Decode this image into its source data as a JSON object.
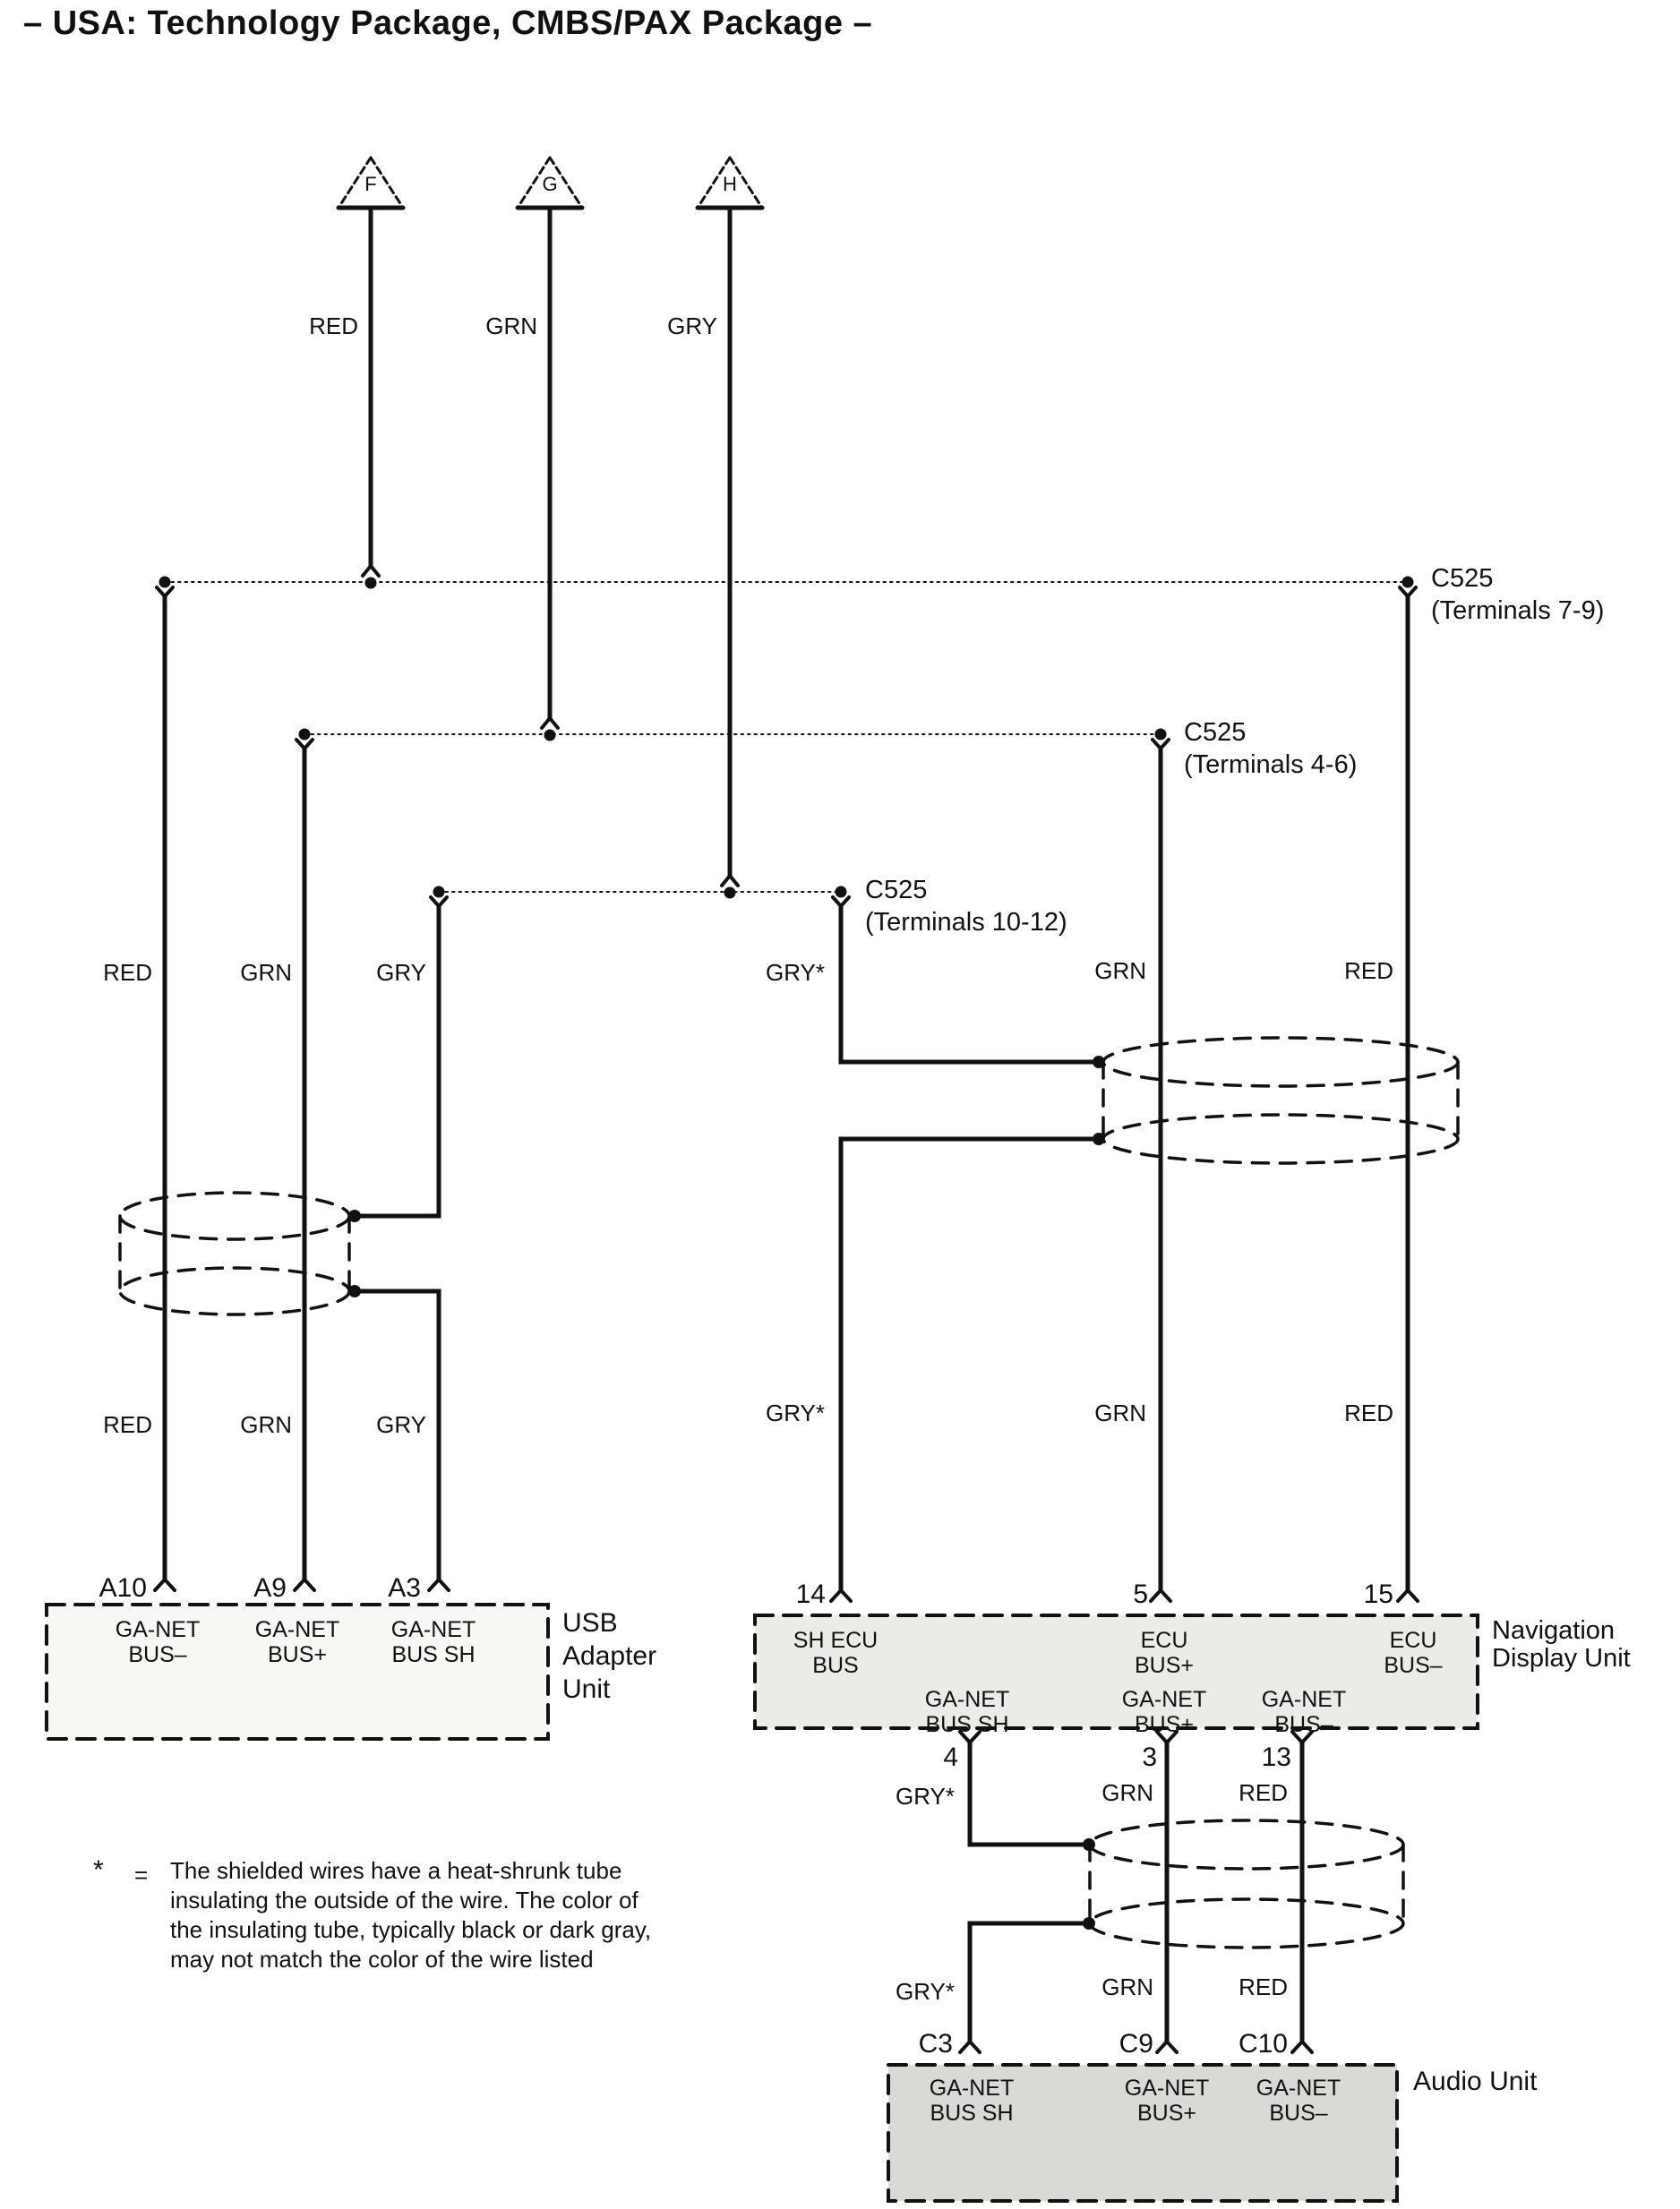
{
  "title": "– USA: Technology Package, CMBS/PAX Package –",
  "triangles": [
    "F",
    "G",
    "H"
  ],
  "wire_labels": {
    "top": [
      "RED",
      "GRN",
      "GRY"
    ],
    "left_row1": [
      "RED",
      "GRN",
      "GRY"
    ],
    "left_row2": [
      "RED",
      "GRN",
      "GRY"
    ],
    "right_row1": [
      "GRY*",
      "GRN",
      "RED"
    ],
    "right_row2": [
      "GRY*",
      "GRN",
      "RED"
    ],
    "nav_bottom_row1": [
      "GRY*",
      "GRN",
      "RED"
    ],
    "nav_bottom_row2": [
      "GRY*",
      "GRN",
      "RED"
    ]
  },
  "connectors": {
    "c525_7_9": {
      "name": "C525",
      "terminals": "(Terminals 7-9)"
    },
    "c525_4_6": {
      "name": "C525",
      "terminals": "(Terminals 4-6)"
    },
    "c525_10_12": {
      "name": "C525",
      "terminals": "(Terminals 10-12)"
    }
  },
  "usb_unit": {
    "name_lines": [
      "USB",
      "Adapter",
      "Unit"
    ],
    "pins": [
      "A10",
      "A9",
      "A3"
    ],
    "pin_functions": [
      [
        "GA-NET",
        "BUS–"
      ],
      [
        "GA-NET",
        "BUS+"
      ],
      [
        "GA-NET",
        "BUS SH"
      ]
    ]
  },
  "nav_unit": {
    "name_lines": [
      "Navigation",
      "Display Unit"
    ],
    "top_pins": [
      "14",
      "5",
      "15"
    ],
    "top_functions": [
      [
        "SH ECU",
        "BUS"
      ],
      [
        "ECU",
        "BUS+"
      ],
      [
        "ECU",
        "BUS–"
      ]
    ],
    "bottom_pins": [
      "4",
      "3",
      "13"
    ],
    "bottom_functions": [
      [
        "GA-NET",
        "BUS SH"
      ],
      [
        "GA-NET",
        "BUS+"
      ],
      [
        "GA-NET",
        "BUS–"
      ]
    ]
  },
  "audio_unit": {
    "name": "Audio Unit",
    "pins": [
      "C3",
      "C9",
      "C10"
    ],
    "pin_functions": [
      [
        "GA-NET",
        "BUS SH"
      ],
      [
        "GA-NET",
        "BUS+"
      ],
      [
        "GA-NET",
        "BUS–"
      ]
    ]
  },
  "footnote": {
    "symbol": "*",
    "equals": "=",
    "lines": [
      "The shielded wires have a heat-shrunk tube",
      "insulating the outside of the wire.  The color of",
      "the insulating tube, typically black or dark gray,",
      "may not match the color of the wire listed"
    ]
  },
  "colors": {
    "ink": "#111111",
    "usb_fill": "#f7f7f4",
    "nav_fill": "#ebebe8",
    "audio_fill": "#d9d9d6"
  }
}
